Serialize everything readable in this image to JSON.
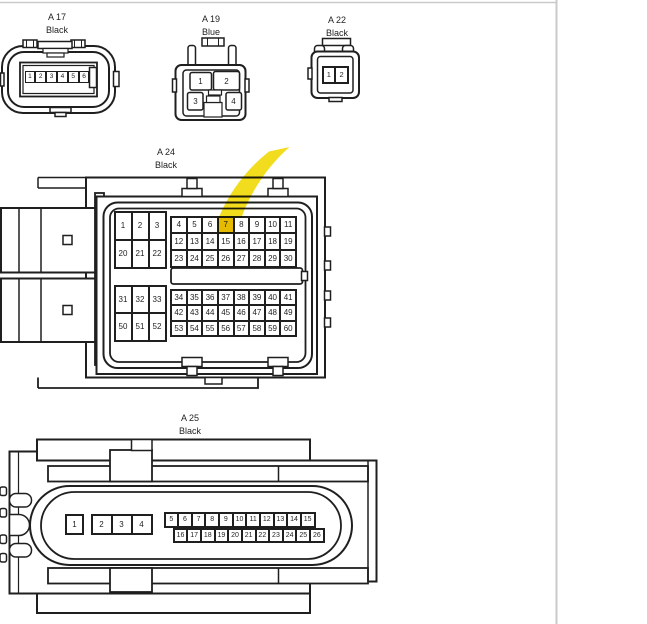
{
  "page": {
    "bg": "#ffffff",
    "rule_color": "#cacaca",
    "line_color": "#1f1f1f"
  },
  "highlight": {
    "connector": "A 24",
    "pin": "7",
    "color": "#f1d90b"
  },
  "connectors": {
    "a17": {
      "id": "A 17",
      "color_label": "Black",
      "pins": [
        "1",
        "2",
        "3",
        "4",
        "5",
        "6"
      ]
    },
    "a19": {
      "id": "A 19",
      "color_label": "Blue",
      "pins": [
        "1",
        "2",
        "3",
        "4"
      ]
    },
    "a22": {
      "id": "A 22",
      "color_label": "Black",
      "pins": [
        "1",
        "2"
      ]
    },
    "a24": {
      "id": "A 24",
      "color_label": "Black",
      "grid_top_left": [
        "1",
        "2",
        "3",
        "20",
        "21",
        "22"
      ],
      "grid_top_right": [
        "4",
        "5",
        "6",
        "7",
        "8",
        "9",
        "10",
        "11",
        "12",
        "13",
        "14",
        "15",
        "16",
        "17",
        "18",
        "19",
        "23",
        "24",
        "25",
        "26",
        "27",
        "28",
        "29",
        "30"
      ],
      "grid_bottom_left": [
        "31",
        "32",
        "33",
        "50",
        "51",
        "52"
      ],
      "grid_bottom_right": [
        "34",
        "35",
        "36",
        "37",
        "38",
        "39",
        "40",
        "41",
        "42",
        "43",
        "44",
        "45",
        "46",
        "47",
        "48",
        "49",
        "53",
        "54",
        "55",
        "56",
        "57",
        "58",
        "59",
        "60"
      ]
    },
    "a25": {
      "id": "A 25",
      "color_label": "Black",
      "pin_1": [
        "1"
      ],
      "pins_2_4": [
        "2",
        "3",
        "4"
      ],
      "row_top": [
        "5",
        "6",
        "7",
        "8",
        "9",
        "10",
        "11",
        "12",
        "13",
        "14",
        "15"
      ],
      "row_bottom": [
        "16",
        "17",
        "18",
        "19",
        "20",
        "21",
        "22",
        "23",
        "24",
        "25",
        "26"
      ]
    }
  }
}
